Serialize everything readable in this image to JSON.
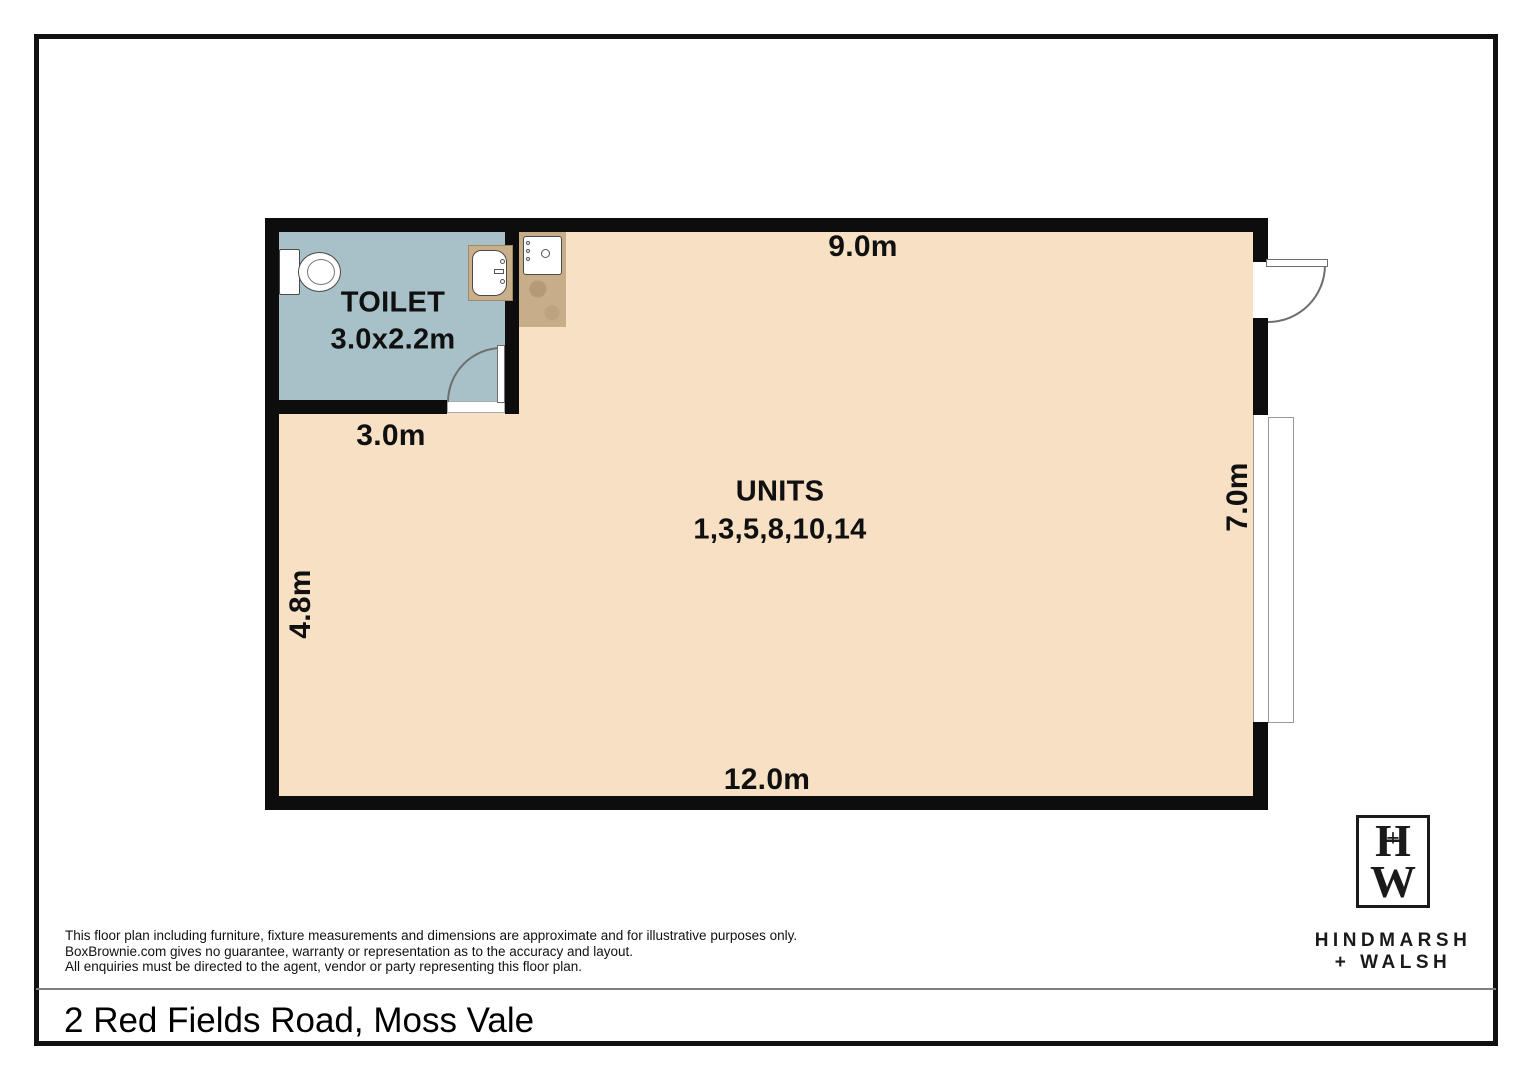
{
  "floorplan": {
    "toilet": {
      "label": "TOILET",
      "dims": "3.0x2.2m",
      "width_label": "3.0m"
    },
    "units": {
      "label": "UNITS",
      "numbers": "1,3,5,8,10,14"
    },
    "dims": {
      "top": "9.0m",
      "bottom": "12.0m",
      "left": "4.8m",
      "right": "7.0m"
    },
    "colors": {
      "floor": "#f7e0c3",
      "toilet_floor": "#a8c0c8",
      "counter": "#c7ae88",
      "wall": "#0d0d0d"
    }
  },
  "disclaimer": {
    "line1": "This floor plan including furniture, fixture measurements and dimensions are approximate and for illustrative purposes only.",
    "line2": "BoxBrownie.com gives no guarantee, warranty or representation as to the accuracy and layout.",
    "line3": "All enquiries must be directed to the agent, vendor or party representing this floor plan."
  },
  "address": "2 Red Fields Road, Moss Vale",
  "logo": {
    "monogram_top": "H",
    "monogram_plus": "+",
    "monogram_bottom": "W",
    "name_line1": "HINDMARSH",
    "name_line2": "+ WALSH"
  }
}
